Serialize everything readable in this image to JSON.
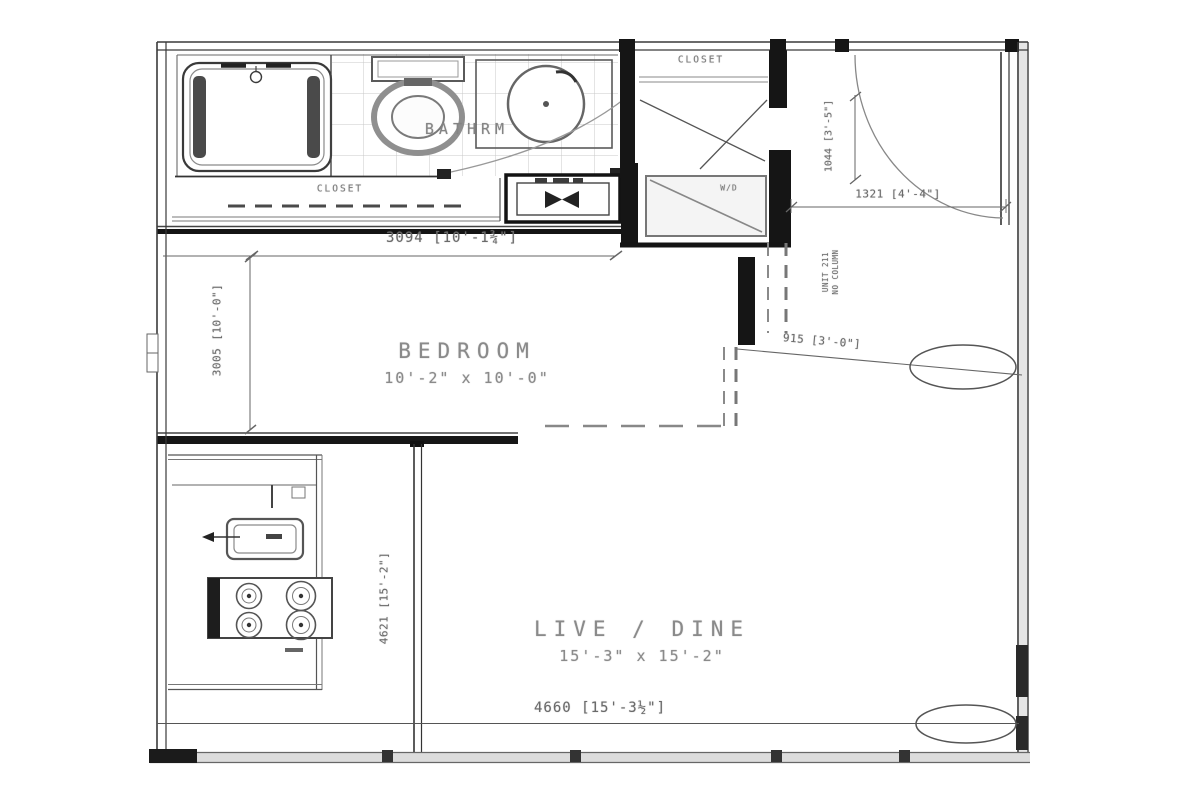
{
  "plan": {
    "labels": {
      "bathroom": "BATHRM",
      "hall_closet": "CLOSET",
      "entry_closet": "CLOSET",
      "washer_dryer": "W/D",
      "bedroom_name": "BEDROOM",
      "bedroom_size": "10'-2\" x 10'-0\"",
      "livedine_name": "LIVE / DINE",
      "livedine_size": "15'-3\" x 15'-2\""
    },
    "dimensions": {
      "bedroom_width": "3094 [10'-1¾\"]",
      "bedroom_depth": "3005 [10'-0\"]",
      "entry_closet_depth": "1044 [3'-5\"]",
      "entry_width": "1321 [4'-4\"]",
      "bedroom_opening": "915 [3'-0\"]",
      "kitchen_run": "4621 [15'-2\"]",
      "living_width": "4660 [15'-3½\"]"
    },
    "notes": {
      "unit": "UNIT 211",
      "column": "NO COLUMN"
    }
  }
}
